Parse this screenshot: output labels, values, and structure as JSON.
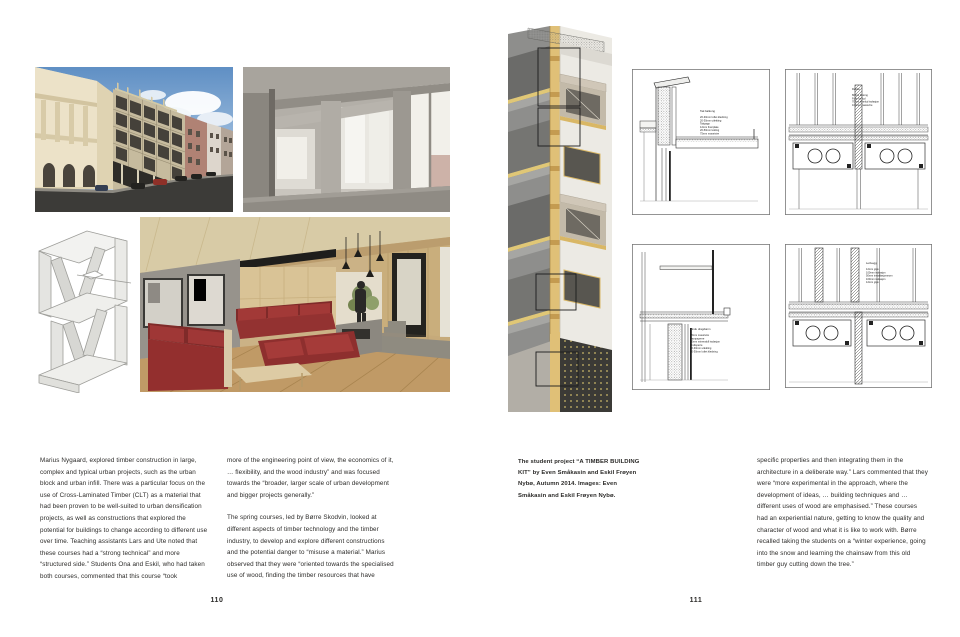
{
  "left_page": {
    "page_number": "110",
    "body": {
      "col1": "Marius Nygaard, explored timber construction in large, complex and typical urban projects, such as the urban block and urban infill. There was a particular focus on the use of Cross-Laminated Timber (CLT) as a material that had been proven to be well-suited to urban densification projects, as well as constructions that explored the potential for buildings to change according to different use over time. Teaching assistants Lars and Ute noted that these courses had a “strong technical” and more “structured side.” Students Ona and Eskil, who had taken both courses, commented that this course “took",
      "col2_para1": "more of the engineering point of view, the economics of it, … flexibility, and the wood industry” and was focused towards the “broader, larger scale of urban development and bigger projects generally.”",
      "col2_para2": "The spring courses, led by Børre Skodvin, looked at different aspects of timber technology and the timber industry, to develop and explore different constructions and the potential danger to “misuse a material.” Marius observed that they were “oriented towards the specialised use of wood, finding the timber resources that have"
    }
  },
  "right_page": {
    "page_number": "111",
    "caption": "The student project “A TIMBER BUILDING KIT” by Even Småkasin and Eskil Frøyen Nybø, Autumn 2014. Images: Even Småkasin and Eskil Frøyen Nybø.",
    "body_col": "specific properties and then integrating them in the architecture in a deliberate way.” Lars commented that they were “more experimental in the approach, where the development of ideas, … building techniques and … different uses of wood are emphasised.” These courses had an experiential nature, getting to know the quality and character of wood and what it is like to work with. Børre recalled taking the students on a “winter experience, going into the snow and learning the chainsaw from this old timber guy cutting down the tree.”",
    "details": [
      {
        "title": "Tak balkong",
        "items": [
          "20-30mm luftet kledning",
          "20-30mm utlekting",
          "Takpapp",
          "12mm finerplate",
          "20-50mm lekting",
          "75mm massivtre"
        ]
      },
      {
        "title": "Dekke",
        "items": [
          "80mm betong",
          "Folie for lyd",
          "70mm trinnlyd isolasjon",
          "100mm massivtre"
        ]
      },
      {
        "title": "Vindu drag/karm",
        "items": [
          "75mm massivtre",
          "Dampsperre",
          "50mm mineralull isolasjon",
          "Vindsperre",
          "20-30mm utlekting",
          "20-30mm luftet kledning"
        ]
      },
      {
        "title": "Lettvegg",
        "items": [
          "12mm gips",
          "100mm isolasjon",
          "50mm installasjonsrom",
          "100mm isolasjon",
          "12mm gips"
        ]
      }
    ]
  },
  "colors": {
    "background": "#ffffff",
    "text": "#2b2a28",
    "sky_blue": "#5f8fc4",
    "timber_yellow": "#e0c077",
    "sofa_red": "#9a3231"
  }
}
